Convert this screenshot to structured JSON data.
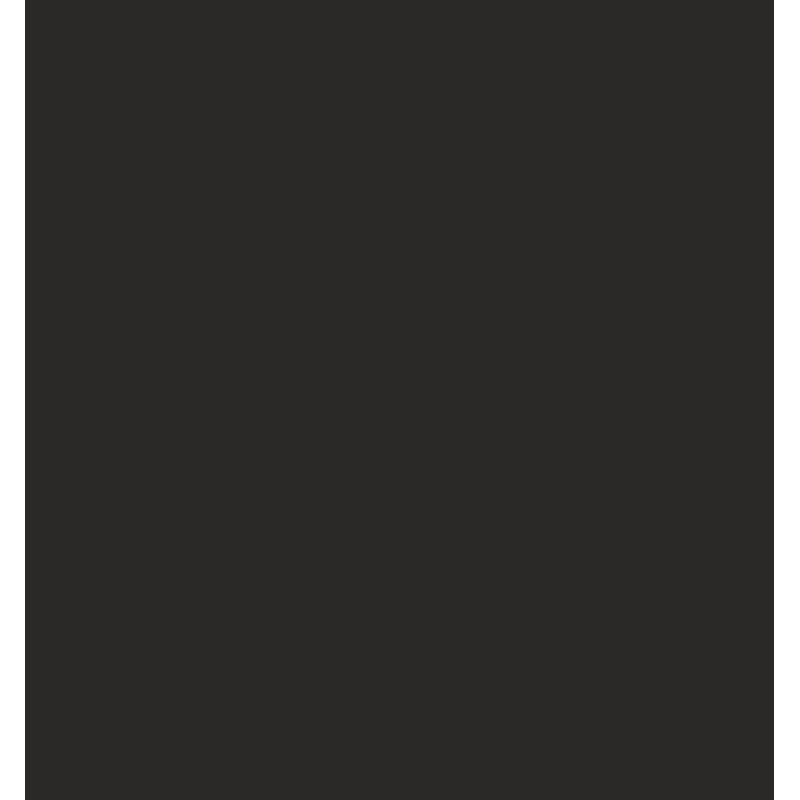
{
  "screen": {
    "background_color": "#ffffff",
    "content_color": "#2a2927",
    "content_text": ""
  }
}
